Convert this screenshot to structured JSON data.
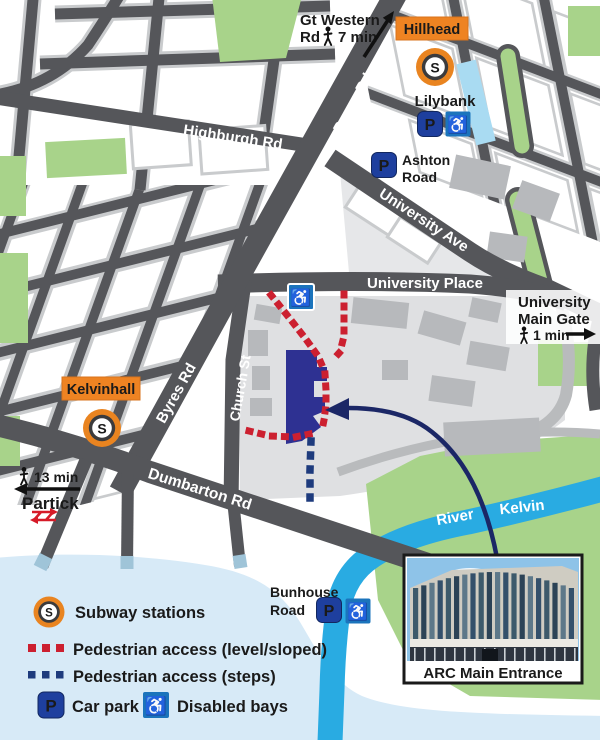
{
  "badges": {
    "hillhead": "Hillhead",
    "kelvinhall": "Kelvinhall"
  },
  "roads": {
    "byres": "Byres Rd",
    "highburgh": "Highburgh Rd",
    "university_ave": "University Ave",
    "university_place": "University Place",
    "church": "Church St",
    "dumbarton": "Dumbarton Rd"
  },
  "labels": {
    "gt_western_line1": "Gt Western",
    "gt_western_line2": "Rd",
    "gt_western_time": "7 min",
    "lilybank": "Lilybank",
    "ashton_line1": "Ashton",
    "ashton_line2": "Road",
    "main_gate_line1": "University",
    "main_gate_line2": "Main Gate",
    "main_gate_time": "1 min",
    "partick_time": "13 min",
    "partick": "Partick",
    "bunhouse_line1": "Bunhouse",
    "bunhouse_line2": "Road",
    "river_word1": "River",
    "river_word2": "Kelvin"
  },
  "icons": {
    "subway_letter": "S",
    "parking_letter": "P",
    "wheelchair": "♿"
  },
  "inset": {
    "caption": "ARC Main Entrance"
  },
  "legend": {
    "subway": "Subway stations",
    "ped_level": "Pedestrian access (level/sloped)",
    "ped_steps": "Pedestrian access (steps)",
    "car_park": "Car park",
    "disabled_bays": "Disabled bays"
  },
  "colors": {
    "orange": "#EE8322",
    "red_dots": "#CC2030",
    "navy_building": "#2E3192",
    "navy_arrow": "#1B2766",
    "blue_dots": "#1E3B7D",
    "river_cyan": "#29ABE2",
    "pale_water": "#D7EAF7",
    "road_grey": "#55565A",
    "green": "#A8D38A",
    "parking_blue": "#1E3F9E",
    "disabled_blue": "#1B74BC"
  }
}
